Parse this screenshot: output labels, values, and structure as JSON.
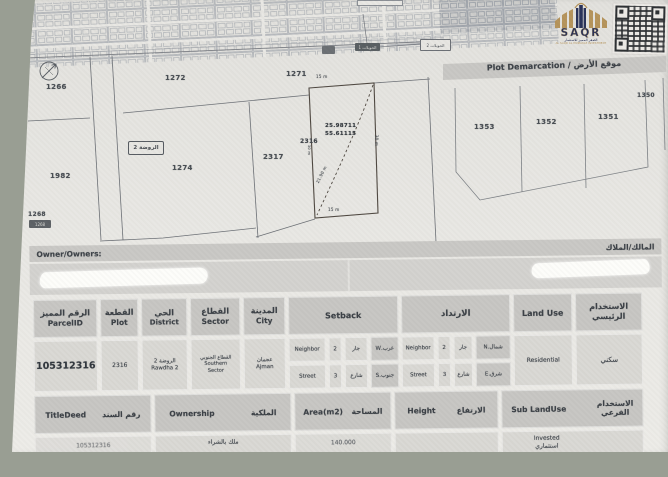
{
  "logo": {
    "name": "SAQR",
    "tagline_ar": "الصقر المميز للاستثمار",
    "tagline_en": "AL SAQR AL MUMAYAZ INVESTMENT"
  },
  "map": {
    "plot_1266": "1266",
    "plot_1272": "1272",
    "plot_1271": "1271",
    "plot_1274": "1274",
    "plot_2317": "2317",
    "plot_1982": "1982",
    "plot_1268": "1268",
    "plot_2316": "2316",
    "area_box": "الروضة 2",
    "coord_lat": "25.98711",
    "coord_lng": "55.61115",
    "meas_top": "15 m",
    "meas_bottom": "15 m",
    "meas_diag": "21.90 m",
    "meas_right": "30 m",
    "meas_left": "30 m",
    "road_badge_dark": "الحويلات 1",
    "road_badge_light": "الحويلات 2",
    "edge_badge": "1268"
  },
  "demarcation": {
    "title": "Plot Demarcation / موقع الأرض",
    "plot_1353": "1353",
    "plot_1352": "1352",
    "plot_1351": "1351",
    "plot_1350": "1350"
  },
  "owner": {
    "label_en": "Owner/Owners:",
    "label_ar": "المالك/الملاك"
  },
  "upper_table": {
    "h_parcel_ar": "الرقم المميز",
    "h_parcel_en": "ParcelID",
    "h_plot_ar": "القطعة",
    "h_plot_en": "Plot",
    "h_district_ar": "الحي",
    "h_district_en": "District",
    "h_sector_ar": "القطاع",
    "h_sector_en": "Sector",
    "h_city_ar": "المدينة",
    "h_city_en": "City",
    "h_setback_en": "Setback",
    "h_setback_ar": "الارتداد",
    "h_landuse_en": "Land Use",
    "h_landuse_ar_1": "الاستخدام",
    "h_landuse_ar_2": "الرئيسي",
    "v_parcel": "105312316",
    "v_plot": "2316",
    "v_district_ar": "الروضة 2",
    "v_district_en": "Rawdha 2",
    "v_sector_ar": "القطاع الجنوبي",
    "v_sector_en_1": "Southern",
    "v_sector_en_2": "Sector",
    "v_city_ar": "عجمان",
    "v_city_en": "Ajman",
    "sb": {
      "neighbor": "Neighbor",
      "street": "Street",
      "n2": "2",
      "n3": "3",
      "jar": "جار",
      "sharia": "شارع",
      "west": "غرب.W",
      "south": "جنوب.S",
      "north": "شمال.N",
      "east": "شرق.E"
    },
    "v_landuse_en": "Residential",
    "v_landuse_ar": "سكني"
  },
  "lower_table": {
    "h_titledeed_en": "TitleDeed",
    "h_titledeed_ar": "رقم السند",
    "h_ownership_en": "Ownership",
    "h_ownership_ar": "الملكية",
    "h_area_en": "Area(m2)",
    "h_area_ar": "المساحة",
    "h_height_en": "Height",
    "h_height_ar": "الارتفاع",
    "h_sublanduse_en": "Sub LandUse",
    "h_sublanduse_ar_1": "الاستخدام",
    "h_sublanduse_ar_2": "الفرعي",
    "v_titledeed": "105312316",
    "v_ownership": "ملك بالشراء",
    "v_area": "140.000",
    "v_sublanduse_en": "Invested",
    "v_sublanduse_ar": "استثماري"
  }
}
